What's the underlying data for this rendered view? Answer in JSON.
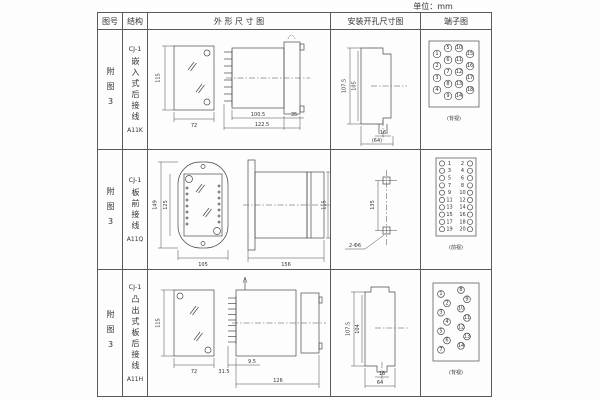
{
  "unit_label": "单位：mm",
  "header": {
    "fig_no": "图号",
    "structure": "结构",
    "outline": "外 形 尺 寸 图",
    "install": "安装开孔尺寸图",
    "terminal": "端子图"
  },
  "rows": [
    {
      "fig_no": "附图3",
      "structure_top": "CJ-1",
      "structure_chars": "嵌入式后接线",
      "structure_code": "A11K",
      "outline": {
        "height": "115",
        "width": "72",
        "body_len": "100.5",
        "total_len": "122.5",
        "flange": "35"
      },
      "install": {
        "outer_h": "107.5",
        "inner_h": "105",
        "slot_w": "16",
        "span": "(64)"
      },
      "terminal": {
        "view_label": "(背视)",
        "numbers": [
          "1",
          "2",
          "3",
          "4",
          "5",
          "6",
          "7",
          "8",
          "9",
          "10",
          "11",
          "12",
          "13",
          "14",
          "15",
          "16",
          "17",
          "18"
        ]
      }
    },
    {
      "fig_no": "附图3",
      "structure_top": "CJ-1",
      "structure_chars": "板前接线",
      "structure_code": "A11Q",
      "outline": {
        "outer_h": "149",
        "inner_h": "125",
        "width": "105",
        "length": "156",
        "side_h": "115"
      },
      "install": {
        "pitch": "135",
        "holes": "2-Φ6"
      },
      "terminal": {
        "view_label": "(前视)",
        "left": [
          "1",
          "3",
          "5",
          "7",
          "9",
          "11",
          "13",
          "15",
          "17",
          "19"
        ],
        "right": [
          "2",
          "4",
          "6",
          "8",
          "10",
          "12",
          "14",
          "16",
          "18",
          "20"
        ]
      }
    },
    {
      "fig_no": "附图3",
      "structure_top": "CJ-1",
      "structure_chars": "凸出式板后接线",
      "structure_code": "A11H",
      "outline": {
        "height": "115",
        "width": "72",
        "comb_len": "31.5",
        "inset": "9.5",
        "length": "126"
      },
      "install": {
        "outer_h": "107.5",
        "inner_h": "104",
        "slot_w": "16",
        "span": "64"
      },
      "terminal": {
        "view_label": "(背视)",
        "numbers": [
          "1",
          "2",
          "3",
          "4",
          "5",
          "6",
          "7",
          "8",
          "9",
          "10",
          "11",
          "12",
          "13",
          "14"
        ]
      }
    }
  ]
}
